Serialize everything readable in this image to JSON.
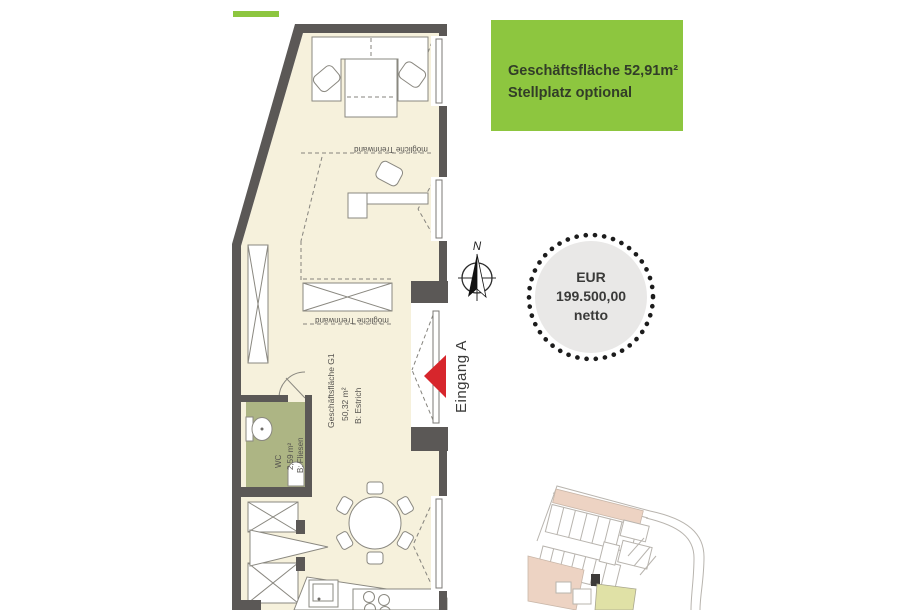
{
  "info_box": {
    "area_line": "Geschäftsfläche 52,91m²",
    "parking_line": "Stellplatz optional"
  },
  "price_badge": {
    "currency": "EUR",
    "amount": "199.500,00",
    "net": "netto"
  },
  "compass": {
    "north": "N"
  },
  "entrance": {
    "label": "Eingang A"
  },
  "floor_plan": {
    "partition_top": "mögliche Trennwand",
    "partition_mid": "mögliche Trennwand",
    "main_room": {
      "name": "Geschäftsfläche G1",
      "area": "50,32 m²",
      "finish": "B: Estrich"
    },
    "wc": {
      "name": "WC",
      "area": "2,59 m²",
      "finish": "B: Fliesen"
    }
  },
  "colors": {
    "accent-green": "#8dc63f",
    "info-text": "#323d28",
    "wall": "#5b5856",
    "floor": "#f6f1dc",
    "wc-floor": "#adb584",
    "arrow-red": "#d7262c",
    "badge-fill": "#e9e8e7",
    "badge-dots": "#1c1c1c",
    "plan-line": "#8a8880",
    "label": "#55534f",
    "site-line": "#b8b4ae",
    "site-salmon": "#edd3c3",
    "site-yellow": "#e0e1a6"
  }
}
